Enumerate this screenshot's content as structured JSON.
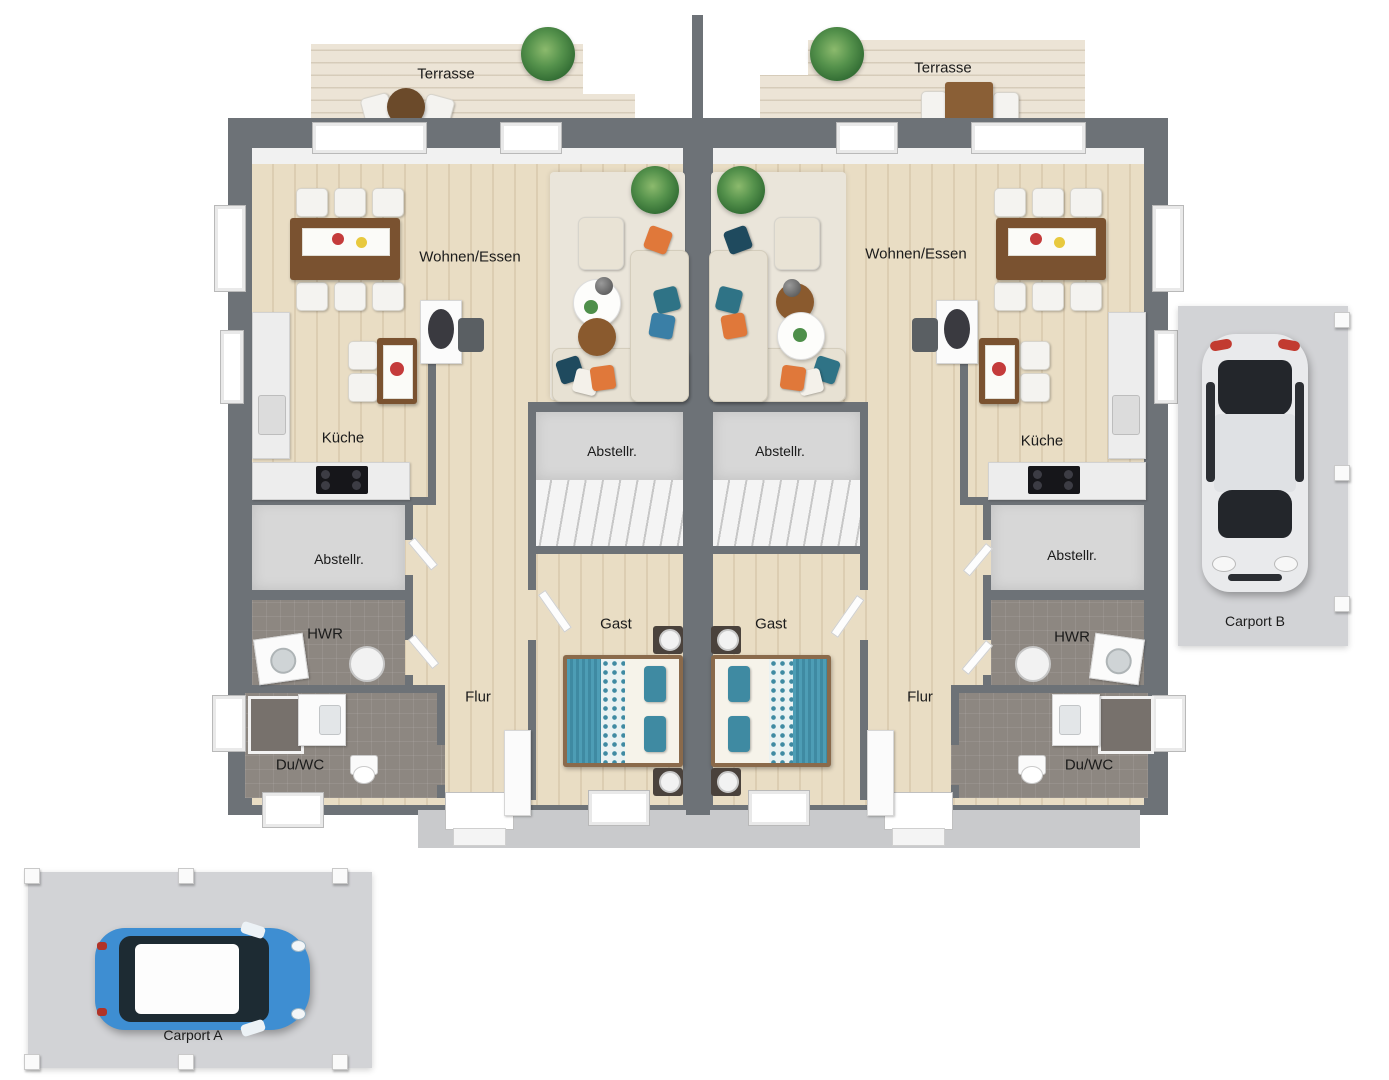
{
  "plan_type": "duplex-ground-floor-plan",
  "labels": {
    "terrace_left": "Terrasse",
    "terrace_right": "Terrasse",
    "living_left": "Wohnen/Essen",
    "living_right": "Wohnen/Essen",
    "kitchen_left": "Küche",
    "kitchen_right": "Küche",
    "storage_center_left": "Abstellr.",
    "storage_center_right": "Abstellr.",
    "storage_side_left": "Abstellr.",
    "storage_side_right": "Abstellr.",
    "utility_left": "HWR",
    "utility_right": "HWR",
    "guest_left": "Gast",
    "guest_right": "Gast",
    "hall_left": "Flur",
    "hall_right": "Flur",
    "bath_left": "Du/WC",
    "bath_right": "Du/WC",
    "carport_a": "Carport A",
    "carport_b": "Carport B"
  },
  "colors": {
    "wall": "#6d7277",
    "wood_floor": "#e9ddc4",
    "terrace_deck": "#ece4d6",
    "tile_floor": "#8d8781",
    "storage_floor": "#d7d7d7",
    "rug": "#eae5da",
    "sofa": "#e7e1d3",
    "accent_orange": "#e0783a",
    "accent_teal": "#2f7386",
    "accent_blue": "#3a7fa6",
    "bed_teal": "#4d9db5",
    "table_wood": "#7a5230",
    "car_blue": "#3e8ed2",
    "car_white": "#e9eaec",
    "carport_pad": "#d2d3d6"
  }
}
